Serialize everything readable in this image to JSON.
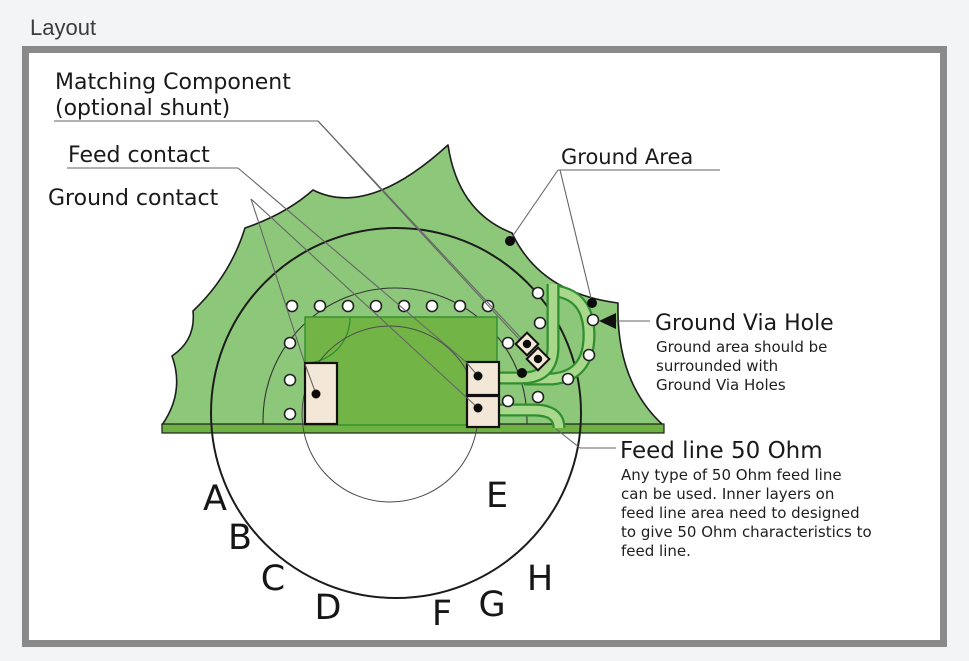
{
  "page": {
    "title": "Layout"
  },
  "diagram": {
    "labels": {
      "matching_component": {
        "line1": "Matching Component",
        "line2": "(optional shunt)"
      },
      "feed_contact": "Feed contact",
      "ground_contact": "Ground contact",
      "ground_area": "Ground Area",
      "ground_via_hole": {
        "title": "Ground Via Hole",
        "note_lines": [
          "Ground area should be",
          "surrounded with",
          "Ground Via Holes"
        ]
      },
      "feed_line": {
        "title": "Feed line 50 Ohm",
        "note_lines": [
          "Any type of 50 Ohm feed line",
          "can be used. Inner layers on",
          "feed line area need to designed",
          "to give 50 Ohm characteristics to",
          "feed line."
        ]
      },
      "position_letters": [
        "A",
        "B",
        "C",
        "D",
        "E",
        "F",
        "G",
        "H"
      ]
    },
    "colors": {
      "page_background": "#f3f4f5",
      "panel_border": "#8a8a8a",
      "board_green": "#8dc87a",
      "inner_layer_green": "#72b546",
      "trace_fill_green": "#a9d88d",
      "trace_edge_green": "#2f8f2f",
      "pad_beige": "#f3e8d7",
      "line_dark": "#1d1d1d"
    }
  }
}
